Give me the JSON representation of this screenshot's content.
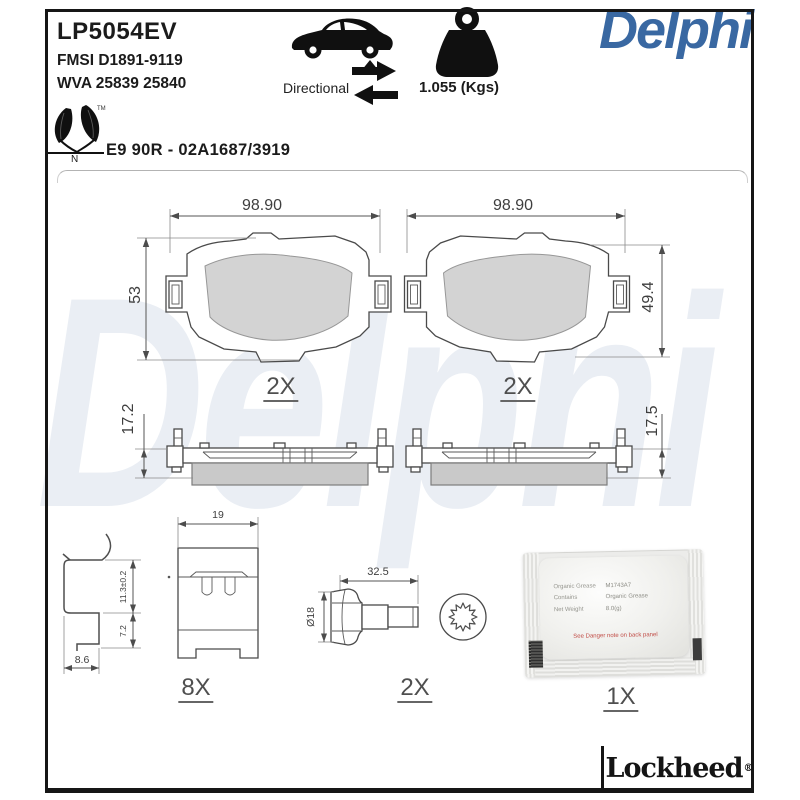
{
  "header": {
    "part_number": "LP5054EV",
    "fmsi": "FMSI D1891-9119",
    "wva": "WVA 25839 25840",
    "directional_label": "Directional",
    "weight_value": "1.055 (Kgs)",
    "brand_logo": "Delphi",
    "eco_tm": "TM",
    "eco_n": "N",
    "approval_code": "E9 90R - 02A1687/3919"
  },
  "watermark_text": "Delphi",
  "colors": {
    "brand_blue": "#3968A2",
    "watermark_blue": "#EAEEF4",
    "friction_gray": "#D3D3D3"
  },
  "pad_front_left": {
    "width_dim": "98.90",
    "height_dim": "53",
    "qty": "2X"
  },
  "pad_front_right": {
    "width_dim": "98.90",
    "height_dim": "49.4",
    "qty": "2X"
  },
  "pad_side_left": {
    "thickness_dim": "17.2"
  },
  "pad_side_right": {
    "thickness_dim": "17.5"
  },
  "clip": {
    "width_dim": "19",
    "upper_height_dim": "11.3±0.2",
    "lower_height_dim": "7.2",
    "base_dim": "8.6",
    "qty": "8X"
  },
  "bolt": {
    "length_dim": "32.5",
    "diameter_dim": "Ø18",
    "qty": "2X"
  },
  "grease_sachet": {
    "rows": [
      {
        "label": "Organic Grease",
        "value": "M1743A7"
      },
      {
        "label": "Contains",
        "value": "Organic Grease"
      },
      {
        "label": "Net Weight",
        "value": "8.0(g)"
      }
    ],
    "warning": "See Danger note on back panel",
    "qty": "1X"
  },
  "footer": {
    "brand": "Lockheed",
    "registered": "®"
  }
}
